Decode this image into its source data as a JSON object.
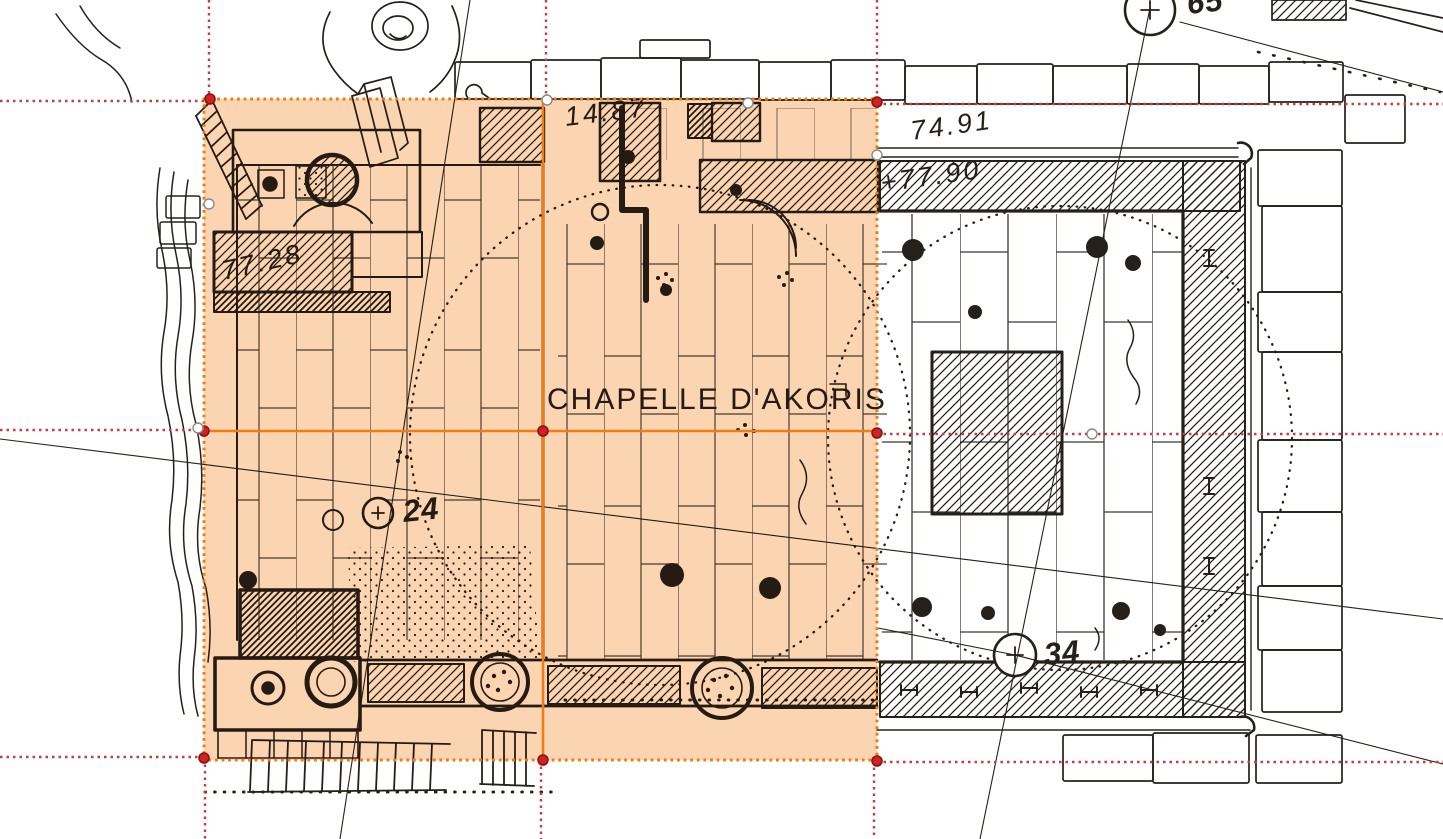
{
  "labels": {
    "chapel_title": "CHAPELLE D'AKORIS",
    "elev_inner_west": "77.28",
    "elev_inner_court": "14.87",
    "elev_outer_court": "74.91",
    "elev_enclosure_wall": "+77.90",
    "survey_point_24": "24",
    "survey_point_34": "34",
    "survey_point_top": "65"
  },
  "selection": {
    "x": 204,
    "y": 99,
    "width": 673,
    "height": 661,
    "columns": 2,
    "rows": 2,
    "tile_boundary_x": 543,
    "tile_boundary_y": 431,
    "border_color": "#ed7d17",
    "fill_color": "#f59a45",
    "fill_opacity": 0.42,
    "handles": [
      [
        547,
        100
      ],
      [
        748,
        103
      ],
      [
        209,
        204
      ],
      [
        198,
        428
      ],
      [
        877,
        155
      ],
      [
        1092,
        434
      ]
    ]
  },
  "grid": {
    "line_color": "#c83c3c",
    "horizontal_y": [
      101,
      431,
      760
    ],
    "vertical_x": [
      208,
      543,
      877
    ],
    "node_markers": [
      [
        210,
        99
      ],
      [
        877,
        102
      ],
      [
        204,
        431
      ],
      [
        543,
        431
      ],
      [
        877,
        433
      ],
      [
        204,
        758
      ],
      [
        543,
        760
      ],
      [
        877,
        761
      ]
    ],
    "node_color": "#d42020"
  },
  "colors": {
    "paper": "#ffffff",
    "ink": "#26201a",
    "overlay_tint": "#f8d5ab",
    "selection_orange": "#ed7d17",
    "guide_red": "#c83c3c"
  }
}
